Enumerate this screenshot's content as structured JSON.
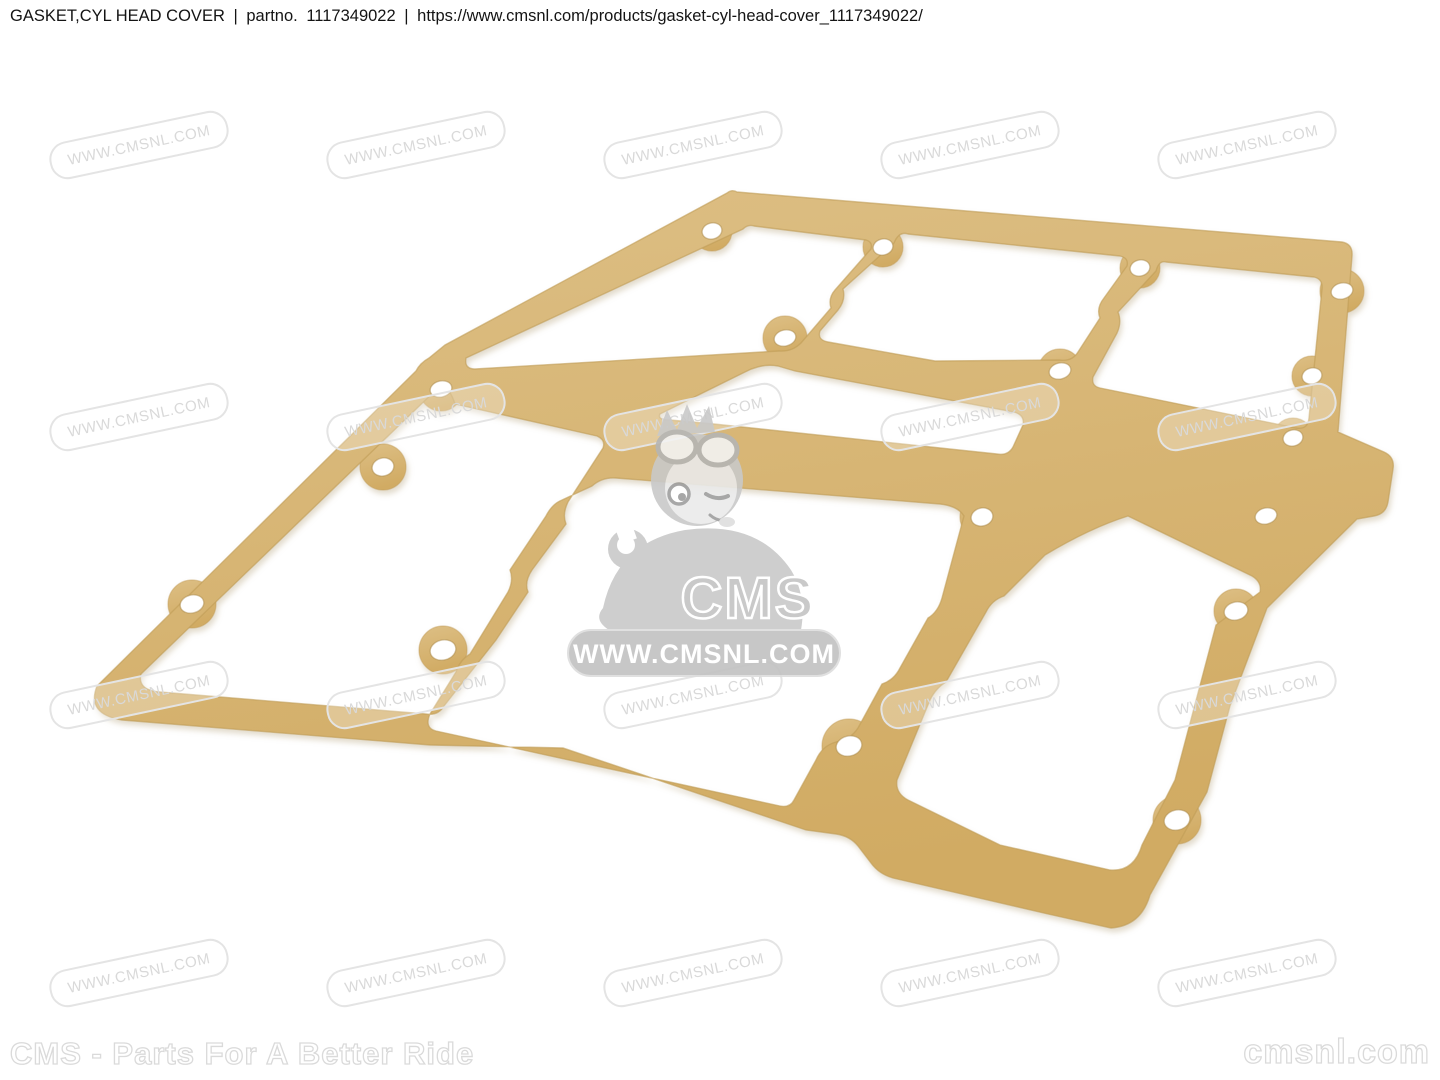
{
  "page": {
    "background": "#ffffff"
  },
  "header": {
    "title": "GASKET,CYL HEAD COVER",
    "separator": "|",
    "part_label": "partno.",
    "part_number": "1117349022",
    "url": "https://www.cmsnl.com/products/gasket-cyl-head-cover_1117349022/"
  },
  "product": {
    "name": "Gasket, cylinder head cover",
    "part_number": "1117349022",
    "color_light": "#ddbf85",
    "color_dark": "#d1ab63",
    "edge_color": "#c09c57",
    "hole_color": "#ffffff",
    "hole_rim_color": "#ab8c4d"
  },
  "watermark": {
    "text": "WWW.CMSNL.COM",
    "color": "#d9d9d9"
  },
  "logo": {
    "brand": "CMS",
    "site": "WWW.CMSNL.COM",
    "gray": "#c6c6c6",
    "banner_gray": "#c2c2c2"
  },
  "footer": {
    "left": "CMS - Parts For A Better Ride",
    "right": "cmsnl.com"
  }
}
